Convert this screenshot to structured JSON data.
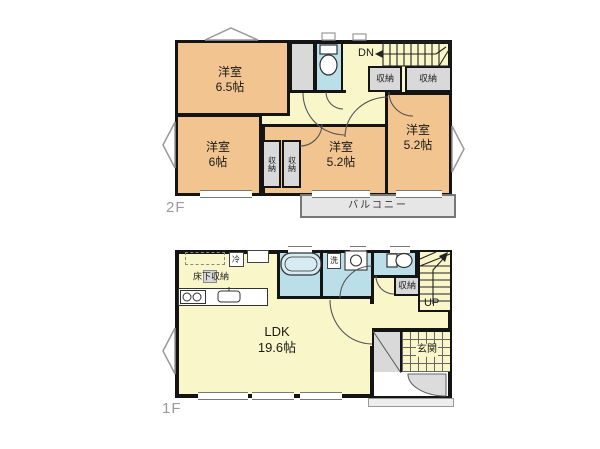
{
  "plan": {
    "floor2": {
      "floor_label": "2F",
      "stairs_label": "DN",
      "balcony_label": "バルコニー",
      "rooms": [
        {
          "name": "洋室",
          "size": "6.5帖"
        },
        {
          "name": "洋室",
          "size": "6帖"
        },
        {
          "name": "洋室",
          "size": "5.2帖"
        },
        {
          "name": "洋室",
          "size": "5.2帖"
        }
      ],
      "closet_top_left_label": "収納",
      "closet_top_right_label": "収納",
      "closet_mid_left_label": "収納",
      "closet_mid_right_label": "収納"
    },
    "floor1": {
      "floor_label": "1F",
      "stairs_label": "UP",
      "ldk": {
        "name": "LDK",
        "size": "19.6帖"
      },
      "underfloor_storage_label": "床下収納",
      "refrigerator_label": "冷",
      "laundry_label": "洗",
      "closet_label": "収納",
      "entrance_label": "玄関"
    },
    "colors": {
      "bedroom_fill": "#f2c48f",
      "hall_fill": "#f9f7c9",
      "wet_area_fill": "#badfe9",
      "closet_fill": "#d9d9d9",
      "balcony_fill": "#e6e6e6",
      "wall": "#141414",
      "background": "#ffffff"
    }
  }
}
